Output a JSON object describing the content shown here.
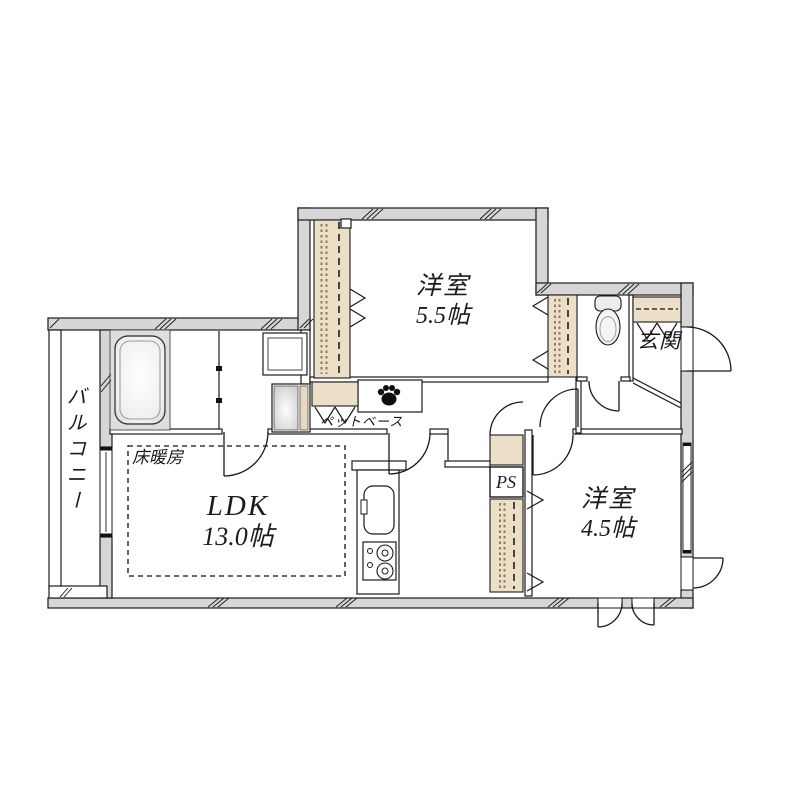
{
  "plan": {
    "rooms": {
      "western_top": {
        "name": "洋室",
        "area": "5.5帖"
      },
      "western_right": {
        "name": "洋室",
        "area": "4.5帖"
      },
      "ldk": {
        "name": "LDK",
        "area": "13.0帖"
      },
      "balcony": {
        "name": "バルコニー"
      },
      "entrance": {
        "name": "玄関"
      }
    },
    "annotations": {
      "floor_heating": "床暖房",
      "pipe_space": "PS",
      "pet_base": "ペットベース"
    },
    "icons": {
      "pet_paw": "paw-icon"
    },
    "colors": {
      "wall_fill": "#d6d6d6",
      "closet_fill": "#ecdfc8",
      "line": "#1a1a1a",
      "background": "#ffffff"
    }
  }
}
